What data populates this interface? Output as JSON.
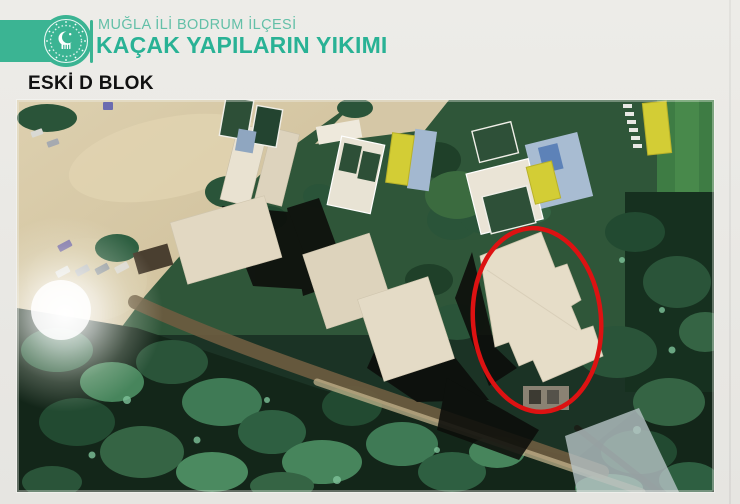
{
  "header": {
    "subtitle": "MUĞLA İLİ BODRUM İLÇESİ",
    "title": "KAÇAK YAPILARIN YIKIMI",
    "logo": "turkish-ministry-environment-emblem",
    "accent_color": "#3bb493",
    "title_color": "#29b295",
    "subtitle_color": "#63c0a8"
  },
  "section": {
    "label": "ESKİ D BLOK",
    "label_color": "#111111"
  },
  "photo": {
    "kind": "aerial-satellite-photo",
    "annotation_shape": "ellipse",
    "annotation_color": "#dd1212"
  }
}
